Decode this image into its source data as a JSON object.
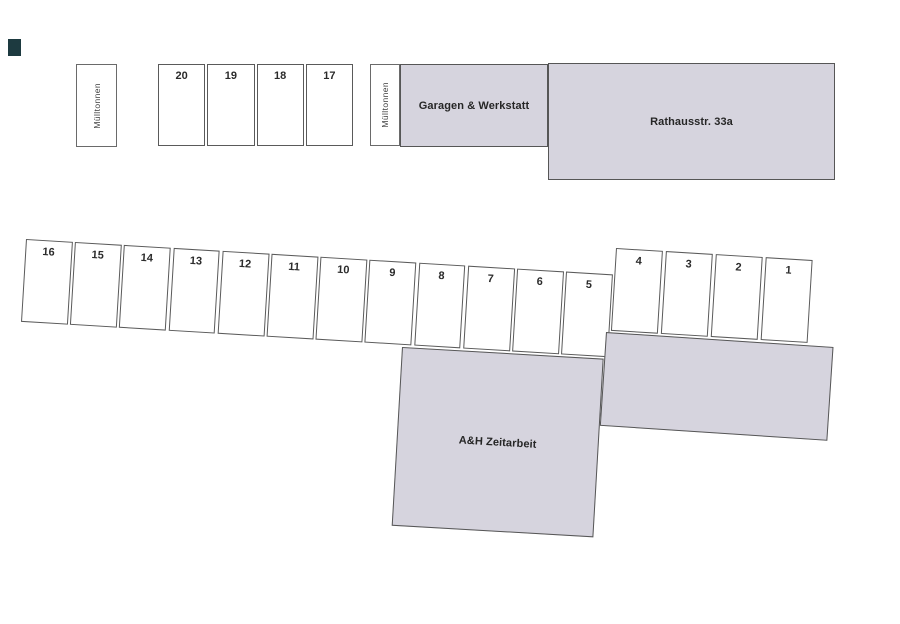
{
  "plan": {
    "type": "parking-site-plan",
    "background": "#ffffff",
    "building_fill": "#d6d4de",
    "outline_color": "#5a5a5a",
    "scan_mark_color": "#1d3a40"
  },
  "waste_areas": [
    {
      "label": "Mülltonnen"
    },
    {
      "label": "Mülltonnen"
    }
  ],
  "buildings": {
    "garagen": {
      "label": "Garagen & Werkstatt"
    },
    "rathaus": {
      "label": "Rathausstr. 33a"
    },
    "zeitarbeit": {
      "label": "A&H Zeitarbeit"
    },
    "annex": {
      "label": ""
    }
  },
  "parking": {
    "top_row": [
      "20",
      "19",
      "18",
      "17"
    ],
    "middle_row": [
      "16",
      "15",
      "14",
      "13",
      "12",
      "11",
      "10",
      "9",
      "8",
      "7",
      "6",
      "5"
    ],
    "right_row": [
      "4",
      "3",
      "2",
      "1"
    ]
  }
}
